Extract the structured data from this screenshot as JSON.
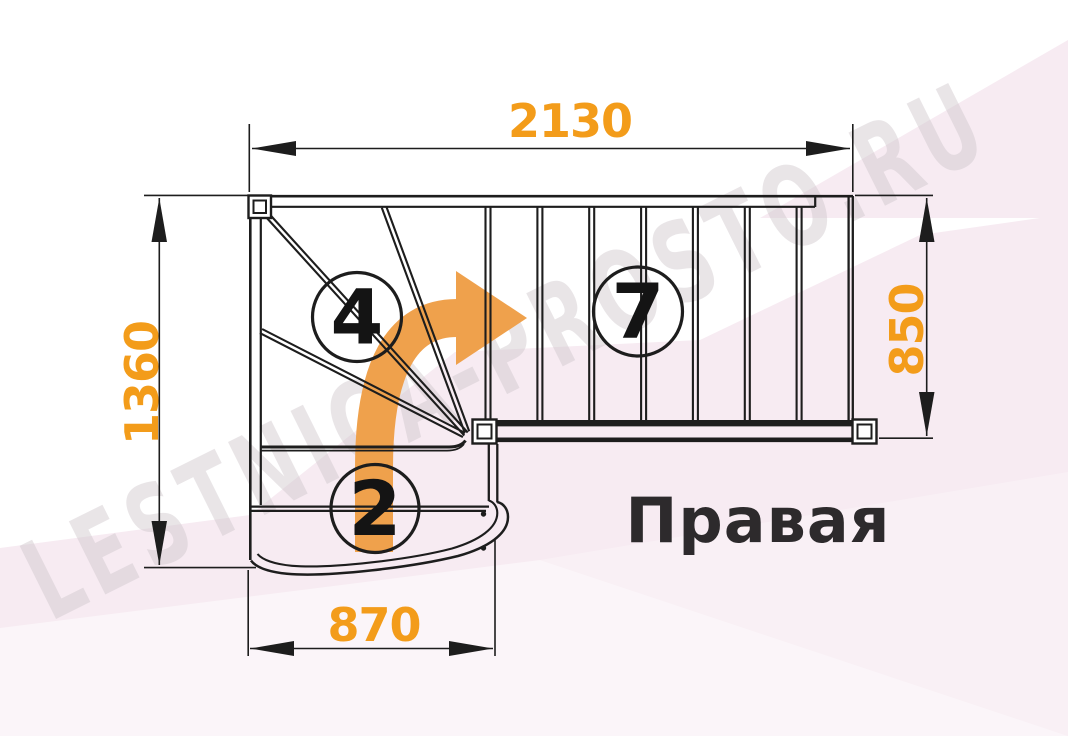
{
  "drawing": {
    "title": "Правая",
    "watermark": "LESTNICA-PROSTO.RU",
    "dimensions": {
      "top_width": "2130",
      "left_height": "1360",
      "right_flight_width": "850",
      "bottom_width": "870"
    },
    "step_counts": {
      "winder": "4",
      "upper_flight": "7",
      "lower_flight": "2"
    },
    "colors": {
      "dimension_text": "#f39c1a",
      "arrow": "#efa14c",
      "line": "#1d1d1d",
      "background_tint": "#f7ebf2",
      "title_text": "#2d2a2c",
      "watermark_gray": "#cfc7cc"
    }
  }
}
